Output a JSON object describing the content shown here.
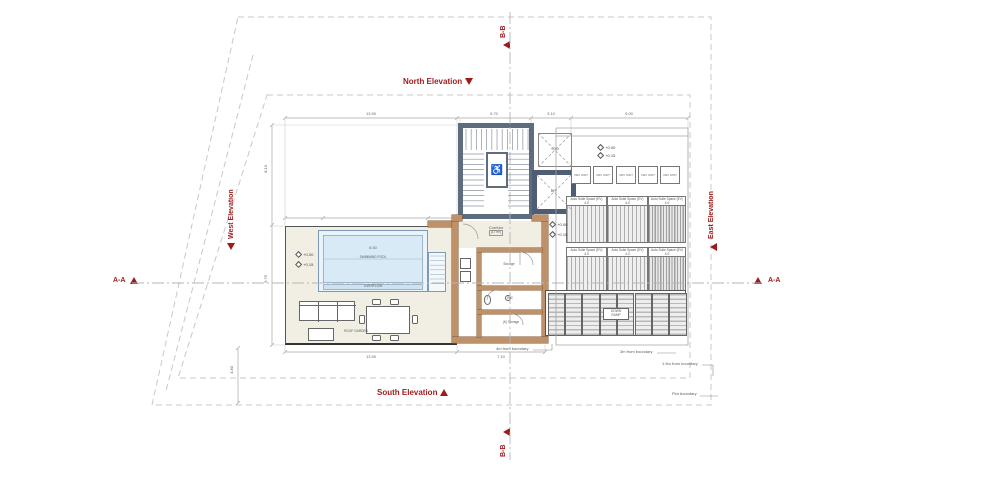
{
  "drawing": {
    "elevations": {
      "north": "North Elevation",
      "south": "South Elevation",
      "west": "West Elevation",
      "east": "East Elevation"
    },
    "sections": {
      "aa": "A-A",
      "bb": "B-B"
    },
    "rooms": {
      "corridor": {
        "label": "Corridor",
        "area_tag": "(17 m²)"
      },
      "storage": "Storage",
      "wc": "W.C",
      "k_storage": "(K) Storage",
      "swimming_pool": "SWIMMING POOL",
      "overflow": "OVERFLOW",
      "roof_garden": "ROOF GARDEN",
      "void": "VOID",
      "lift": "LIFT",
      "ramp_line1": "DOWN",
      "ramp_line2": "RAMP"
    },
    "levels": {
      "upper": "+0.00",
      "lower": "+0.15"
    },
    "parking": {
      "bays": [
        {
          "label": "Auto Suite Space (EV)",
          "note": "4.0"
        },
        {
          "label": "Auto Suite Space (EV)",
          "note": "4.0"
        },
        {
          "label": "Auto Suite Space (EV)",
          "note": "4.0"
        },
        {
          "label": "Auto Suite Space (EV)",
          "note": "4.0"
        },
        {
          "label": "Auto Suite Space (EV)",
          "note": "4.0"
        },
        {
          "label": "Auto Suite Space (EV)",
          "note": "4.0"
        }
      ],
      "units": [
        "VRV UNIT",
        "VRV UNIT",
        "VRV UNIT",
        "VRV UNIT",
        "VRV UNIT"
      ]
    },
    "boundary_notes": {
      "b4": "4m from boundary",
      "b3": "3m from boundary",
      "b15": "1.5m from boundary",
      "plot": "Plot boundary"
    },
    "dimensions": {
      "pool": "8.50",
      "top": [
        "13.90",
        "5.70",
        "3.10",
        "9.00"
      ],
      "left": [
        "8.10",
        "9.75"
      ],
      "bottom": [
        "13.90",
        "7.10"
      ],
      "side": "4.80"
    },
    "colors": {
      "annotation_red": "#9e1b1b",
      "stair_wall": "#5e6c7f",
      "interior_wall": "#be9169",
      "pool_water": "#d9eaf7",
      "terrace_floor": "#f1eee3",
      "hatch": "#adadad",
      "boundary": "#c8c8c8"
    }
  }
}
